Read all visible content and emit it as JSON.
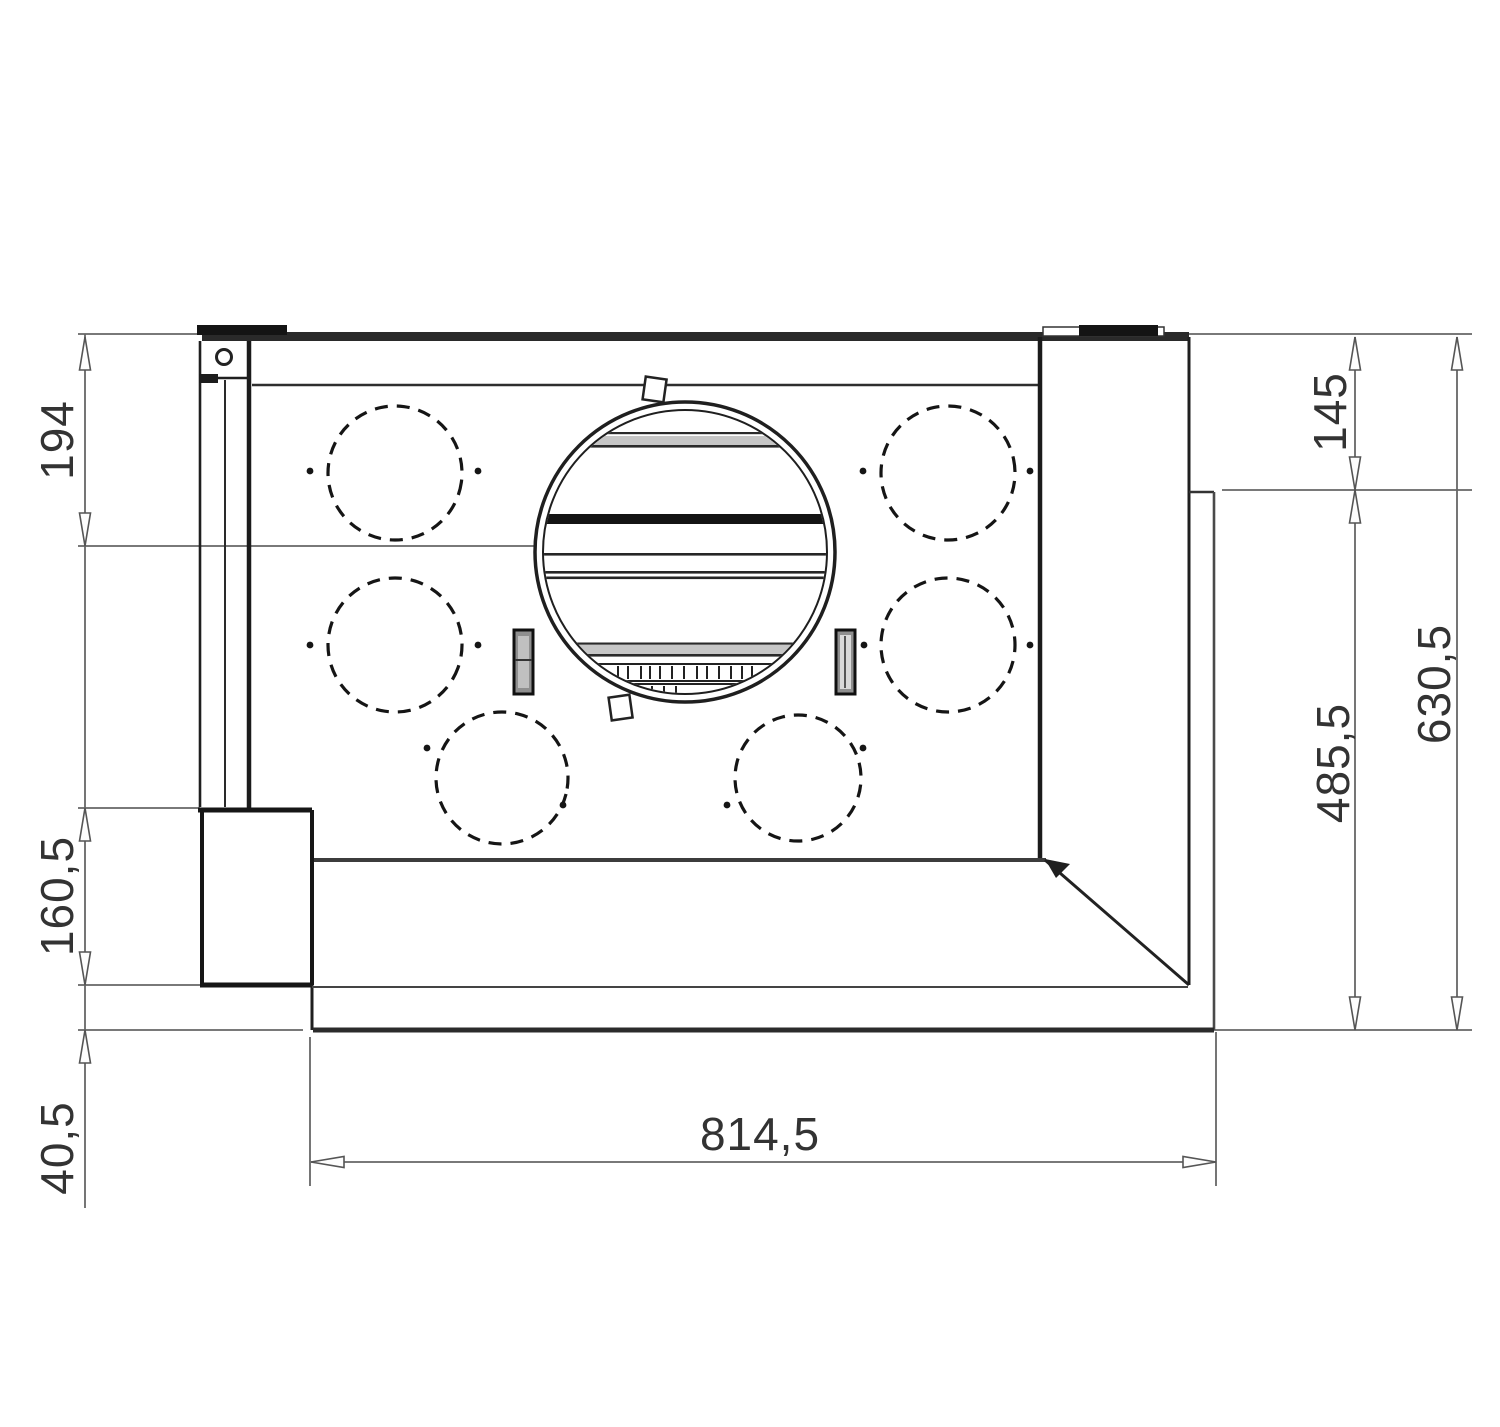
{
  "drawing": {
    "title": "hood-installation-dimension-drawing",
    "dimensions": {
      "left_top": "194",
      "left_middle": "160,5",
      "left_bottom": "40,5",
      "right_inner_top": "145",
      "right_inner_bottom": "485,5",
      "right_outer": "630,5",
      "bottom_width": "814,5"
    },
    "colors": {
      "object_line": "#1f1f1f",
      "dim_line": "#666666",
      "text": "#333333",
      "background": "#ffffff"
    }
  }
}
